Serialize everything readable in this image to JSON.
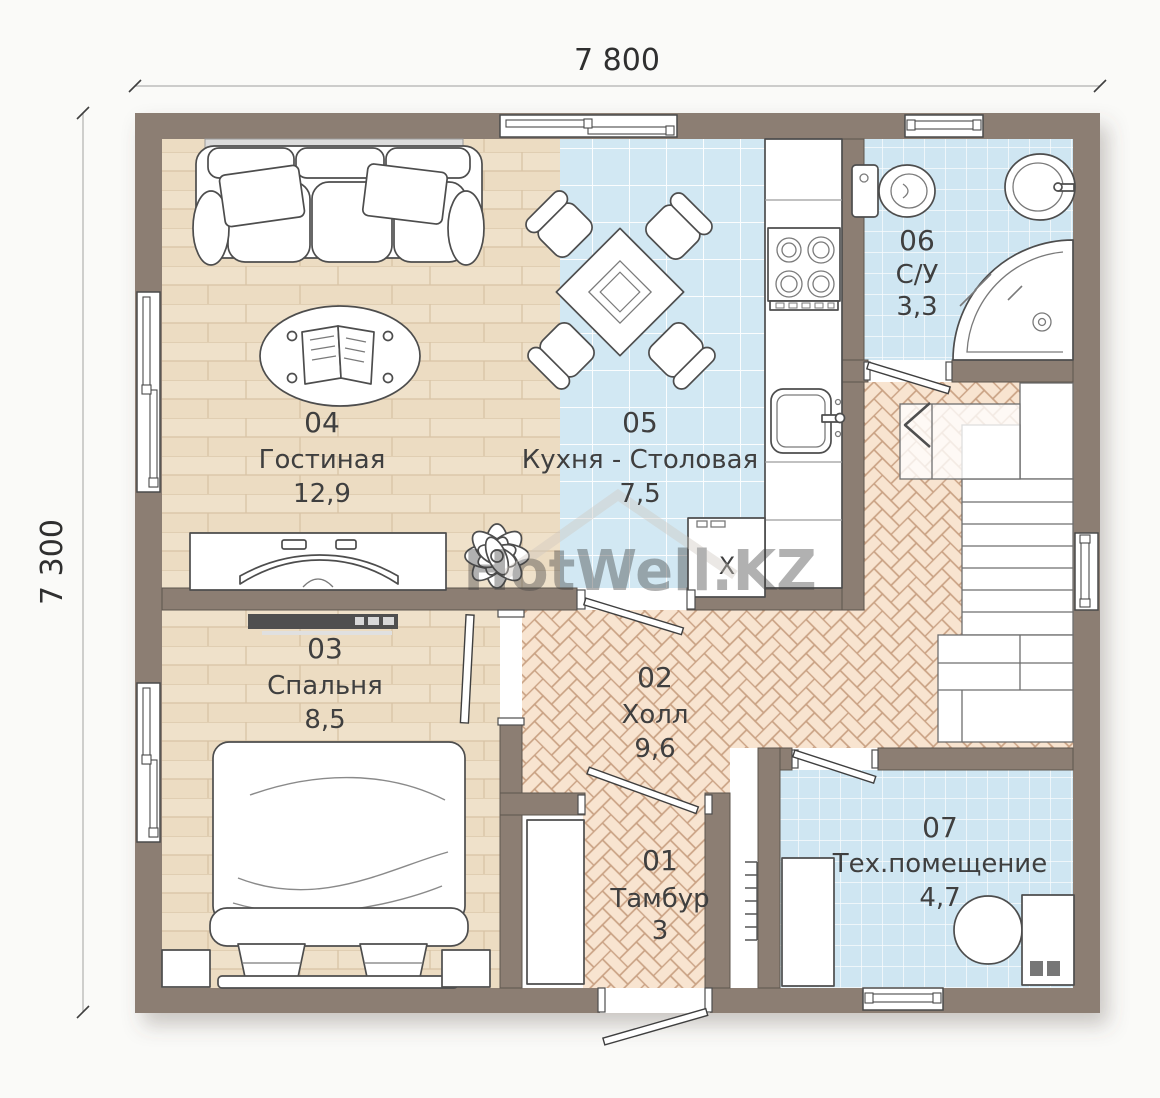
{
  "watermark": {
    "text": "HotWell.KZ"
  },
  "dimensions": {
    "top": "7 800",
    "left": "7 300"
  },
  "rooms": [
    {
      "number": "01",
      "name": "Тамбур",
      "area": "3"
    },
    {
      "number": "02",
      "name": "Холл",
      "area": "9,6"
    },
    {
      "number": "03",
      "name": "Спальня",
      "area": "8,5"
    },
    {
      "number": "04",
      "name": "Гостиная",
      "area": "12,9"
    },
    {
      "number": "05",
      "name": "Кухня - Столовая",
      "area": "7,5"
    },
    {
      "number": "06",
      "name": "С/У",
      "area": "3,3"
    },
    {
      "number": "07",
      "name": "Тех.помещение",
      "area": "4,7"
    }
  ],
  "appliances": {
    "fridge_label": "X"
  },
  "colors": {
    "wall": "#8c7e73",
    "wood_floor": "#efe1ca",
    "wood_line": "#d8c3a5",
    "tile_floor": "#d2e8f3",
    "tile_floor_small": "#cfe6f2",
    "herringbone_floor": "#f8e4d0",
    "herringbone_line": "#c9a183",
    "outline": "#4a4a4a",
    "label": "#3f3f3f"
  }
}
